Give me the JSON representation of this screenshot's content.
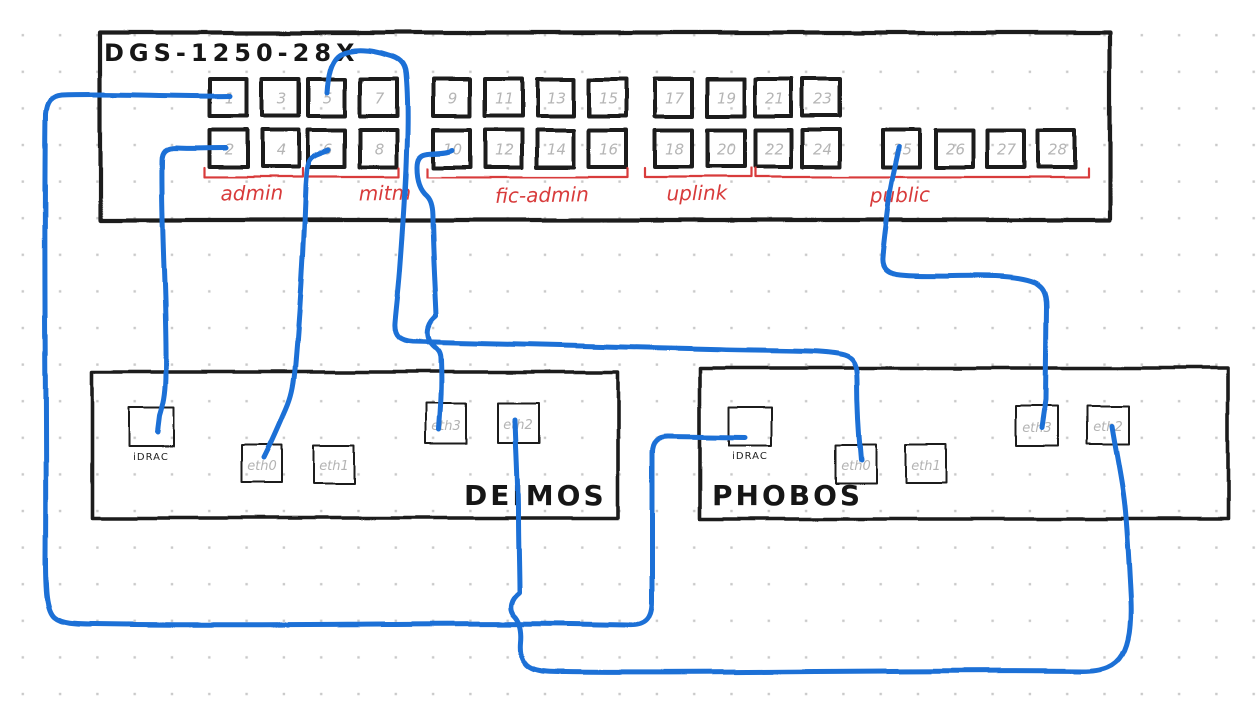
{
  "canvas": {
    "background": "#ffffff",
    "grid_dot_color": "#c9c9c9"
  },
  "diagram": {
    "switch": {
      "title": "DGS-1250-28X",
      "port_numbers": [
        "1",
        "2",
        "3",
        "4",
        "5",
        "6",
        "7",
        "8",
        "9",
        "10",
        "11",
        "12",
        "13",
        "14",
        "15",
        "16",
        "17",
        "18",
        "19",
        "20",
        "21",
        "22",
        "23",
        "24",
        "25",
        "26",
        "27",
        "28"
      ],
      "port_groups": [
        {
          "label": "admin",
          "ports": "1-4"
        },
        {
          "label": "mitm",
          "ports": "5-8"
        },
        {
          "label": "fic-admin",
          "ports": "9-16"
        },
        {
          "label": "uplink",
          "ports": "17-20"
        },
        {
          "label": "public",
          "ports": "21-28"
        }
      ]
    },
    "servers": [
      {
        "name": "DEIMOS",
        "ports": [
          "iDRAC",
          "eth0",
          "eth1",
          "eth3",
          "eth2"
        ]
      },
      {
        "name": "PHOBOS",
        "ports": [
          "iDRAC",
          "eth0",
          "eth1",
          "eth3",
          "eth2"
        ]
      }
    ],
    "connections": [
      {
        "from": "switch:1",
        "to": "PHOBOS:iDRAC"
      },
      {
        "from": "switch:2",
        "to": "DEIMOS:iDRAC"
      },
      {
        "from": "switch:5",
        "to": "PHOBOS:eth0"
      },
      {
        "from": "switch:6",
        "to": "DEIMOS:eth0"
      },
      {
        "from": "switch:10",
        "to": "DEIMOS:eth3"
      },
      {
        "from": "switch:25",
        "to": "PHOBOS:eth3"
      },
      {
        "from": "DEIMOS:eth2",
        "to": "PHOBOS:eth2"
      }
    ],
    "colors": {
      "cable": "#1b6fd6",
      "annotation": "#d83b3b",
      "ink": "#1d1d1d",
      "port_number": "#b5b5b5",
      "port_label": "#b3b3b3"
    }
  }
}
